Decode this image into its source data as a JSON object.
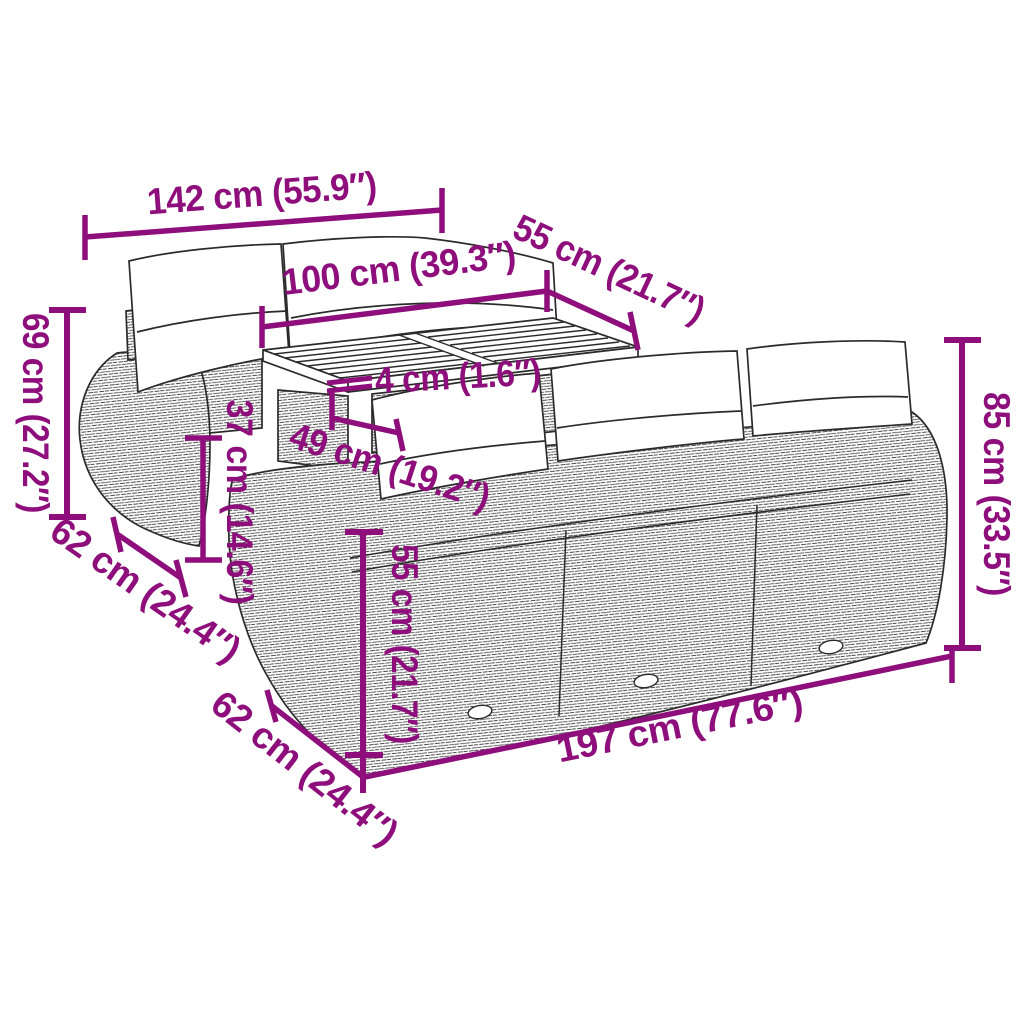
{
  "diagram": {
    "type": "product-dimension-diagram",
    "product": "Garden lounge set of wicker/poly-rattan sofas with white back cushions and a slatted-top coffee table",
    "background_color": "#ffffff",
    "accent_color": "#8E0F7C",
    "line_color": "#2b2b2b",
    "dimensions": [
      {
        "id": "back-sofa-width",
        "label": "142 cm (55.9″)",
        "cm": 142,
        "inches": 55.9
      },
      {
        "id": "table-length",
        "label": "100 cm (39.3″)",
        "cm": 100,
        "inches": 39.3
      },
      {
        "id": "table-depth",
        "label": "55 cm (21.7″)",
        "cm": 55,
        "inches": 21.7
      },
      {
        "id": "tabletop-thickness",
        "label": "4 cm (1.6″)",
        "cm": 4,
        "inches": 1.6
      },
      {
        "id": "table-height",
        "label": "49 cm (19.2″)",
        "cm": 49,
        "inches": 19.2
      },
      {
        "id": "back-sofa-height",
        "label": "69 cm (27.2″)",
        "cm": 69,
        "inches": 27.2
      },
      {
        "id": "seat-height",
        "label": "37 cm (14.6″)",
        "cm": 37,
        "inches": 14.6
      },
      {
        "id": "module-depth-back",
        "label": "62 cm (24.4″)",
        "cm": 62,
        "inches": 24.4
      },
      {
        "id": "sofa-side-height",
        "label": "55 cm (21.7″)",
        "cm": 55,
        "inches": 21.7
      },
      {
        "id": "module-depth-front",
        "label": "62 cm (24.4″)",
        "cm": 62,
        "inches": 24.4
      },
      {
        "id": "front-sofa-length",
        "label": "197 cm (77.6″)",
        "cm": 197,
        "inches": 77.6
      },
      {
        "id": "front-sofa-height",
        "label": "85 cm (33.5″)",
        "cm": 85,
        "inches": 33.5
      }
    ]
  }
}
